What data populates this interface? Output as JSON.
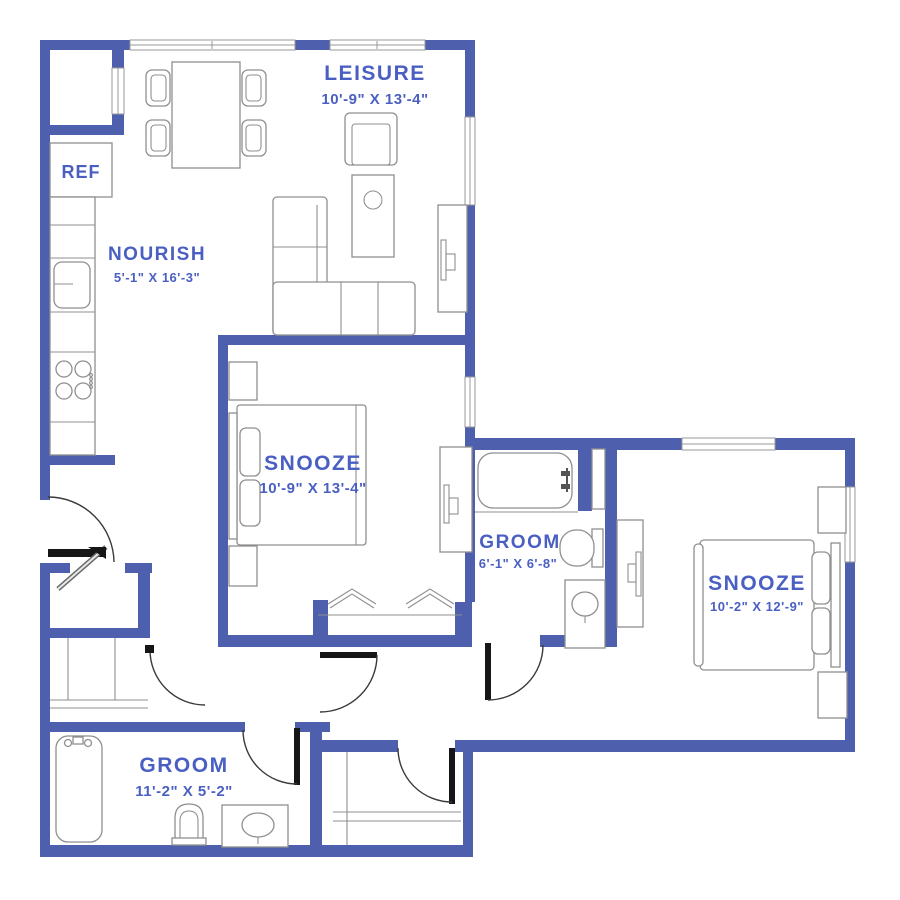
{
  "plan_type": "apartment-floor-plan",
  "palette": {
    "wall_color": "#4e60ad",
    "label_color": "#4a5fc2",
    "furniture_line_color": "#8f8f8f",
    "door_color": "#161616",
    "background": "#ffffff"
  },
  "rooms": {
    "leisure": {
      "name": "LEISURE",
      "dims": "10'-9\" X 13'-4\""
    },
    "nourish": {
      "name": "NOURISH",
      "dims": "5'-1\" X 16'-3\""
    },
    "snooze1": {
      "name": "SNOOZE",
      "dims": "10'-9\" X 13'-4\""
    },
    "groom1": {
      "name": "GROOM",
      "dims": "6'-1\" X 6'-8\""
    },
    "snooze2": {
      "name": "SNOOZE",
      "dims": "10'-2\" X 12'-9\""
    },
    "groom2": {
      "name": "GROOM",
      "dims": "11'-2\" X 5'-2\""
    }
  },
  "appliances": {
    "refrigerator": "REF"
  },
  "fixtures": [
    "dining-table",
    "dining-chairs",
    "kitchen-counter",
    "kitchen-sink",
    "stove",
    "armchair",
    "coffee-table",
    "sectional-sofa",
    "tv-console",
    "bed",
    "nightstands",
    "bathtub",
    "toilet",
    "sink-vanity",
    "linen-closet",
    "bifold-closet-doors",
    "washer-dryer-closet",
    "laundry-closet",
    "entry-door"
  ]
}
